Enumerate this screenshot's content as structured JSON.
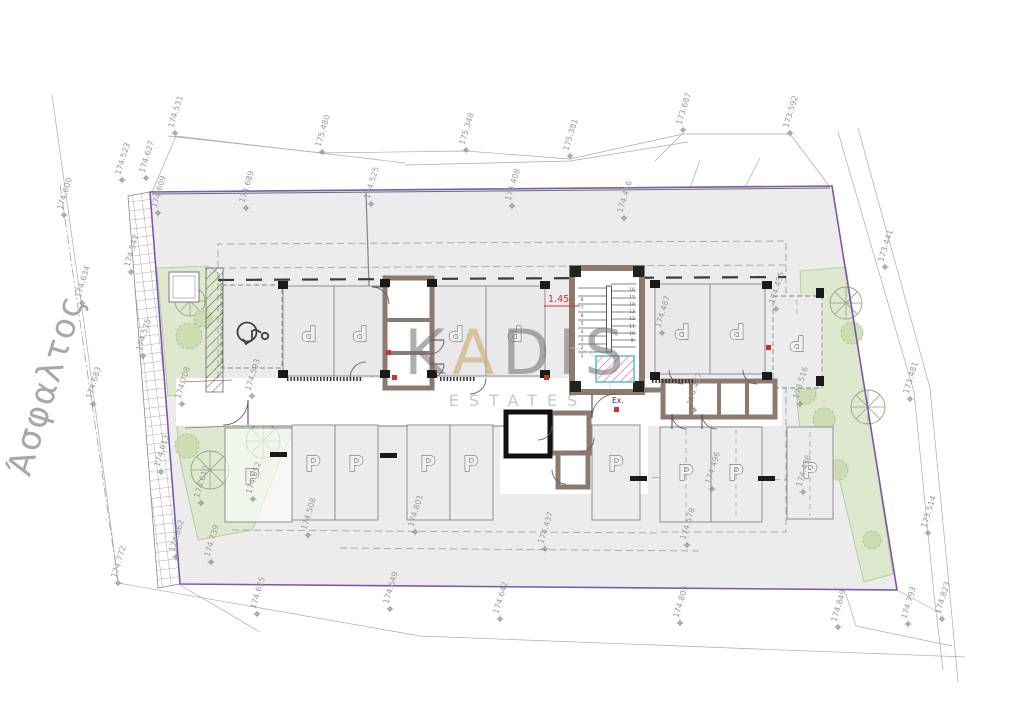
{
  "drawing": {
    "road_label": "Άσφαλτος",
    "watermark": {
      "word": "KADIS",
      "accent_index": 1,
      "line2": "ESTATES",
      "accent_color": "#c9a366",
      "word_color": "#6e6e6e",
      "line2_color": "#9a9a9a"
    },
    "stair": {
      "dim_label": "1.45",
      "exit_label": "Ex.",
      "steps_left_bottom_up": [
        "1",
        "2",
        "3",
        "4",
        "5",
        "6",
        "7",
        "8"
      ],
      "steps_right_top_down": [
        "16",
        "15",
        "14",
        "13",
        "12",
        "11",
        "10",
        "9"
      ]
    },
    "parking_space_label": "P",
    "parking_spaces_rotated": [
      {
        "x": 309,
        "y": 333
      },
      {
        "x": 360,
        "y": 333
      },
      {
        "x": 456,
        "y": 333
      },
      {
        "x": 515,
        "y": 333
      },
      {
        "x": 682,
        "y": 331
      },
      {
        "x": 737,
        "y": 331
      },
      {
        "x": 797,
        "y": 343
      }
    ],
    "parking_spaces_upright": [
      {
        "x": 252,
        "y": 477
      },
      {
        "x": 313,
        "y": 464
      },
      {
        "x": 356,
        "y": 464
      },
      {
        "x": 428,
        "y": 464
      },
      {
        "x": 471,
        "y": 464
      },
      {
        "x": 616,
        "y": 464
      },
      {
        "x": 686,
        "y": 473
      },
      {
        "x": 736,
        "y": 473
      },
      {
        "x": 810,
        "y": 471
      }
    ],
    "elevation_markers": [
      {
        "v": "174.531",
        "x": 175,
        "y": 133
      },
      {
        "v": "175.480",
        "x": 322,
        "y": 152
      },
      {
        "v": "175.348",
        "x": 466,
        "y": 150
      },
      {
        "v": "175.381",
        "x": 570,
        "y": 156
      },
      {
        "v": "173.687",
        "x": 683,
        "y": 130
      },
      {
        "v": "173.592",
        "x": 790,
        "y": 133
      },
      {
        "v": "174.523",
        "x": 122,
        "y": 180
      },
      {
        "v": "174.627",
        "x": 146,
        "y": 178
      },
      {
        "v": "174.600",
        "x": 64,
        "y": 215
      },
      {
        "v": "174.609",
        "x": 158,
        "y": 213
      },
      {
        "v": "174.689",
        "x": 246,
        "y": 208
      },
      {
        "v": "174.525",
        "x": 371,
        "y": 204
      },
      {
        "v": "174.408",
        "x": 512,
        "y": 206
      },
      {
        "v": "174.416",
        "x": 624,
        "y": 218
      },
      {
        "v": "174.634",
        "x": 82,
        "y": 303
      },
      {
        "v": "174.683",
        "x": 93,
        "y": 404
      },
      {
        "v": "174.547",
        "x": 131,
        "y": 272
      },
      {
        "v": "174.575",
        "x": 143,
        "y": 356
      },
      {
        "v": "174.708",
        "x": 182,
        "y": 404
      },
      {
        "v": "174.593",
        "x": 252,
        "y": 396
      },
      {
        "v": "174.613",
        "x": 161,
        "y": 472
      },
      {
        "v": "174.610",
        "x": 201,
        "y": 503
      },
      {
        "v": "174.862",
        "x": 176,
        "y": 557
      },
      {
        "v": "174.739",
        "x": 211,
        "y": 562
      },
      {
        "v": "174.772",
        "x": 118,
        "y": 583
      },
      {
        "v": "174.625",
        "x": 257,
        "y": 614
      },
      {
        "v": "174.649",
        "x": 390,
        "y": 609
      },
      {
        "v": "174.642",
        "x": 500,
        "y": 619
      },
      {
        "v": "174.805",
        "x": 680,
        "y": 623
      },
      {
        "v": "174.849",
        "x": 838,
        "y": 627
      },
      {
        "v": "174.793",
        "x": 908,
        "y": 624
      },
      {
        "v": "174.823",
        "x": 942,
        "y": 619
      },
      {
        "v": "173.441",
        "x": 885,
        "y": 267
      },
      {
        "v": "173.481",
        "x": 910,
        "y": 399
      },
      {
        "v": "173.514",
        "x": 928,
        "y": 533
      },
      {
        "v": "173.516",
        "x": 800,
        "y": 404
      },
      {
        "v": "174.487",
        "x": 662,
        "y": 333
      },
      {
        "v": "174.455",
        "x": 776,
        "y": 309
      },
      {
        "v": "174.437",
        "x": 694,
        "y": 410
      },
      {
        "v": "174.437",
        "x": 545,
        "y": 549
      },
      {
        "v": "174.578",
        "x": 687,
        "y": 545
      },
      {
        "v": "174.496",
        "x": 712,
        "y": 489
      },
      {
        "v": "174.436",
        "x": 803,
        "y": 492
      },
      {
        "v": "174.652",
        "x": 253,
        "y": 499
      },
      {
        "v": "174.508",
        "x": 308,
        "y": 535
      },
      {
        "v": "174.801",
        "x": 415,
        "y": 532
      }
    ],
    "trees": [
      {
        "type": "spoke",
        "x": 190,
        "y": 301,
        "r": 15
      },
      {
        "type": "blob",
        "x": 189,
        "y": 336,
        "r": 13
      },
      {
        "type": "blob",
        "x": 203,
        "y": 318,
        "r": 9
      },
      {
        "type": "spoke",
        "x": 210,
        "y": 470,
        "r": 19
      },
      {
        "type": "spoke",
        "x": 263,
        "y": 441,
        "r": 17
      },
      {
        "type": "blob",
        "x": 187,
        "y": 446,
        "r": 12
      },
      {
        "type": "spoke",
        "x": 846,
        "y": 303,
        "r": 16
      },
      {
        "type": "blob",
        "x": 852,
        "y": 333,
        "r": 11
      },
      {
        "type": "blob",
        "x": 806,
        "y": 394,
        "r": 10
      },
      {
        "type": "blob",
        "x": 824,
        "y": 419,
        "r": 11
      },
      {
        "type": "spoke",
        "x": 868,
        "y": 407,
        "r": 17
      },
      {
        "type": "blob",
        "x": 815,
        "y": 453,
        "r": 11
      },
      {
        "type": "blob",
        "x": 838,
        "y": 470,
        "r": 10
      },
      {
        "type": "blob",
        "x": 872,
        "y": 540,
        "r": 9
      }
    ],
    "colors": {
      "boundary": "#7e57b0",
      "site_fill": "#ececec",
      "green": "#dde8cf",
      "wall_brown": "#8d7a6f",
      "elevator_hatch": "#e87bb5",
      "elevator_border": "#3fbccb",
      "marker_text": "#9b9b9b",
      "red": "#d32f2f"
    }
  }
}
